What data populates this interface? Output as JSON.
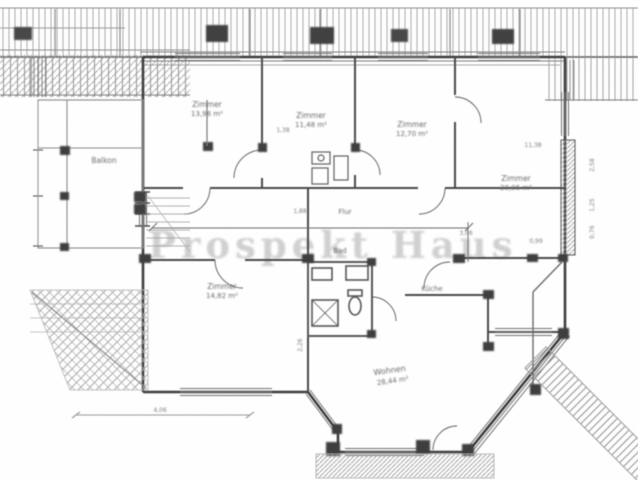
{
  "colors": {
    "ink": "#3d3d3d",
    "wall": "#4a4a4a",
    "hatch": "#8f8f8f",
    "watermark": "#c6c6c6",
    "background": "#ffffff"
  },
  "watermark": {
    "text": "Prospekt Haus"
  },
  "rooms": [
    {
      "name": "Balkon",
      "area": ""
    },
    {
      "name": "Zimmer",
      "area": "13,96 m²"
    },
    {
      "name": "Zimmer",
      "area": "11,48 m²"
    },
    {
      "name": "Zimmer",
      "area": "12,70 m²"
    },
    {
      "name": "Zimmer",
      "area": "20,06 m²"
    },
    {
      "name": "Flur",
      "area": ""
    },
    {
      "name": "Bad",
      "area": ""
    },
    {
      "name": "Zimmer",
      "area": "14,82 m²"
    },
    {
      "name": "Küche",
      "area": ""
    },
    {
      "name": "Wohnen",
      "area": "28,44 m²"
    }
  ],
  "dimensions": {
    "d0": "1,38",
    "d1": "11,38",
    "d2": "1,88",
    "d3": "3,06",
    "d4": "0,99",
    "d5": "2,26",
    "d6": "2,58",
    "d7": "1,25",
    "d8": "4,06",
    "d9": "0,76"
  }
}
